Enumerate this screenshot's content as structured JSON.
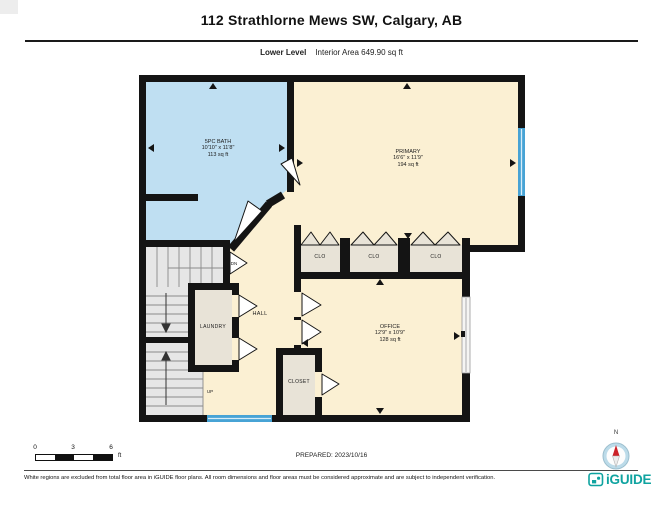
{
  "header": {
    "title": "112 Strathlorne Mews SW, Calgary, AB",
    "level": "Lower Level",
    "interior_area": "Interior Area 649.90 sq ft"
  },
  "plan": {
    "rooms": {
      "bath": {
        "name": "5PC BATH",
        "dims": "10'10\" x 11'8\"",
        "area": "113 sq ft"
      },
      "primary": {
        "name": "PRIMARY",
        "dims": "16'6\" x 11'9\"",
        "area": "194 sq ft"
      },
      "office": {
        "name": "OFFICE",
        "dims": "12'9\" x 10'9\"",
        "area": "128 sq ft"
      },
      "hall": {
        "name": "HALL"
      },
      "laundry": {
        "name": "LAUNDRY"
      },
      "closet": {
        "name": "CLOSET"
      },
      "clo_1": {
        "name": "CLO"
      },
      "clo_2": {
        "name": "CLO"
      },
      "clo_3": {
        "name": "CLO"
      },
      "stairs_down_label": "DN",
      "stairs_up_label": "UP"
    },
    "colors": {
      "room_fill": "#fbf0d3",
      "bath_fill": "#bfdff2",
      "closet_fill": "#e8e3d7",
      "stairs_fill": "#e6e6e6",
      "wall": "#141414",
      "window": "#47a3d5",
      "brand_teal": "#0fa3a0"
    }
  },
  "scale_bar": {
    "tick_0": "0",
    "tick_3": "3",
    "tick_6": "6",
    "unit": "ft"
  },
  "prepared_label": "PREPARED: 2023/10/16",
  "compass": {
    "north": "N"
  },
  "footer": {
    "disclaimer": "White regions are excluded from total floor area in iGUIDE floor plans. All room dimensions and floor areas must be considered approximate and are subject to independent verification.",
    "brand": "iGUIDE"
  }
}
